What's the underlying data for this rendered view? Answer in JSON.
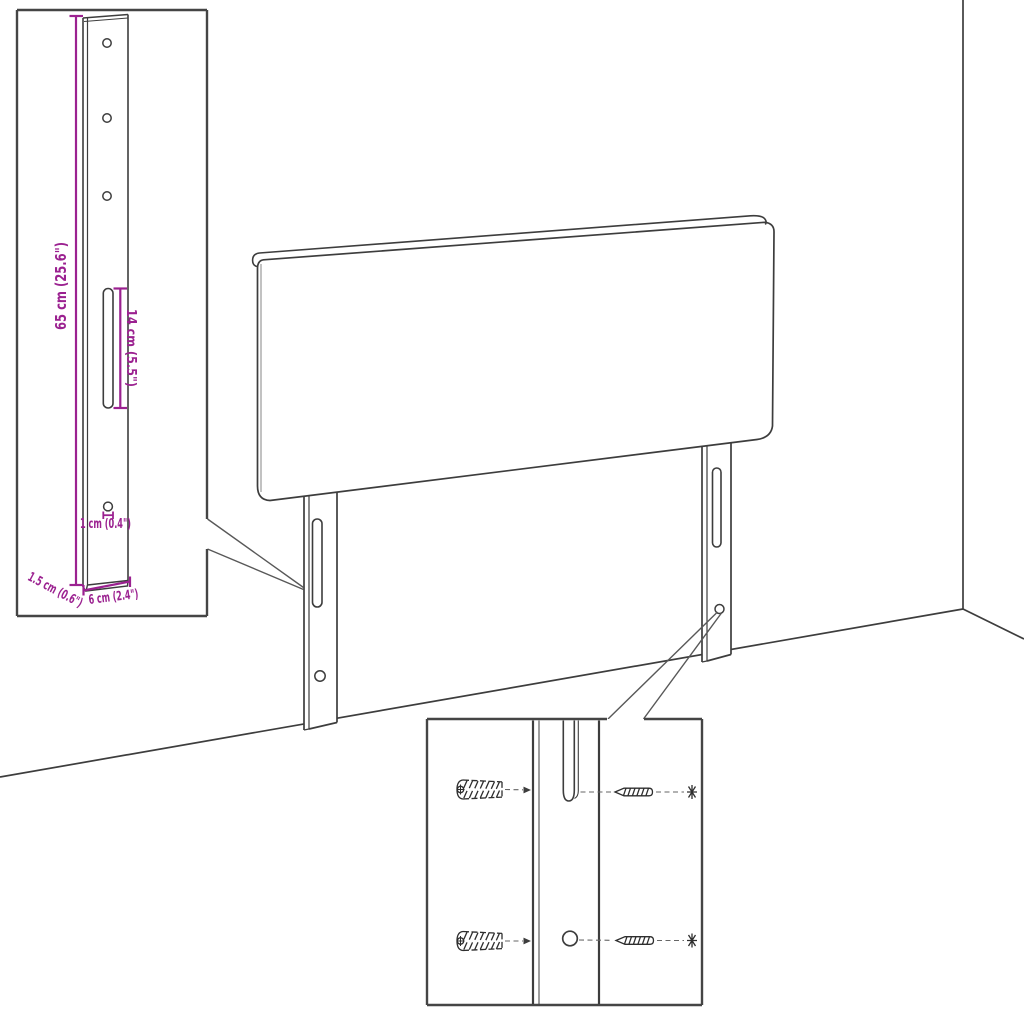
{
  "colors": {
    "accent": "#9B2190",
    "line_art": "#3D3D3D",
    "inset_border": "#454545",
    "background": "#FFFFFF"
  },
  "dimensions": {
    "height": "65 cm (25.6\")",
    "slot_length": "14 cm (5.5\")",
    "hole_diameter": "1 cm (0.4\")",
    "leg_thickness": "1.5 cm (0.6\")",
    "leg_width": "6 cm (2.4\")"
  }
}
